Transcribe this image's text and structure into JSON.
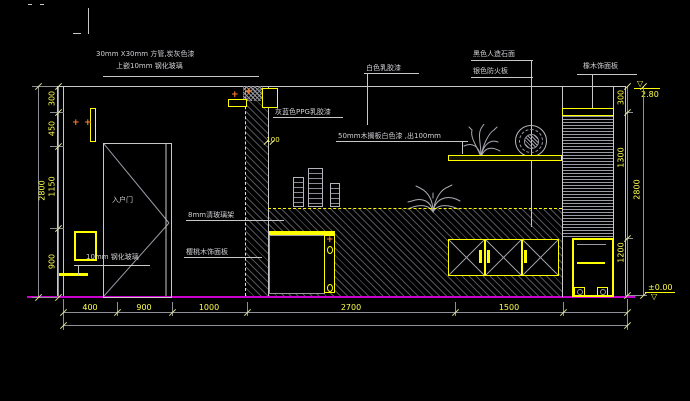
{
  "labels": {
    "square_tube_1": "30mm X30mm 方管,炭灰色漆",
    "square_tube_2": "上嵌10mm 钢化玻璃",
    "white_paint": "白色乳胶漆",
    "black_stone": "黑色人造石面",
    "silver_board": "银色防火板",
    "oak_panel": "橡木饰面板",
    "ppg_paint": "灰蓝色PPG乳胶漆",
    "wood_shelf": "50mm木搁板白色漆 ,出100mm",
    "glass_shelf": "8mm清玻璃架",
    "cherry_panel": "樱桃木饰面板",
    "entry_door": "入户门",
    "tempered_glass": "10mm 钢化玻璃",
    "offset_100": "100"
  },
  "dims": {
    "bottom": [
      "400",
      "900",
      "1000",
      "2700",
      "1500"
    ],
    "left": [
      "300",
      "450",
      "1150",
      "900"
    ],
    "left_total": "2800",
    "right": [
      "300",
      "1300",
      "1200"
    ],
    "right_total": "2800"
  },
  "levels": {
    "top": "2.80",
    "bottom": "±0.00"
  },
  "icons": {
    "plus": "+",
    "triangle_down": "▽"
  },
  "colors": {
    "background": "#000000",
    "line": "#c8c8c8",
    "accent_yellow": "#ffff00",
    "dim_text": "#ffff4f",
    "floor_magenta": "#cc00cc",
    "marker_orange": "#ff7f27",
    "hatch_gray": "#9696a0"
  }
}
